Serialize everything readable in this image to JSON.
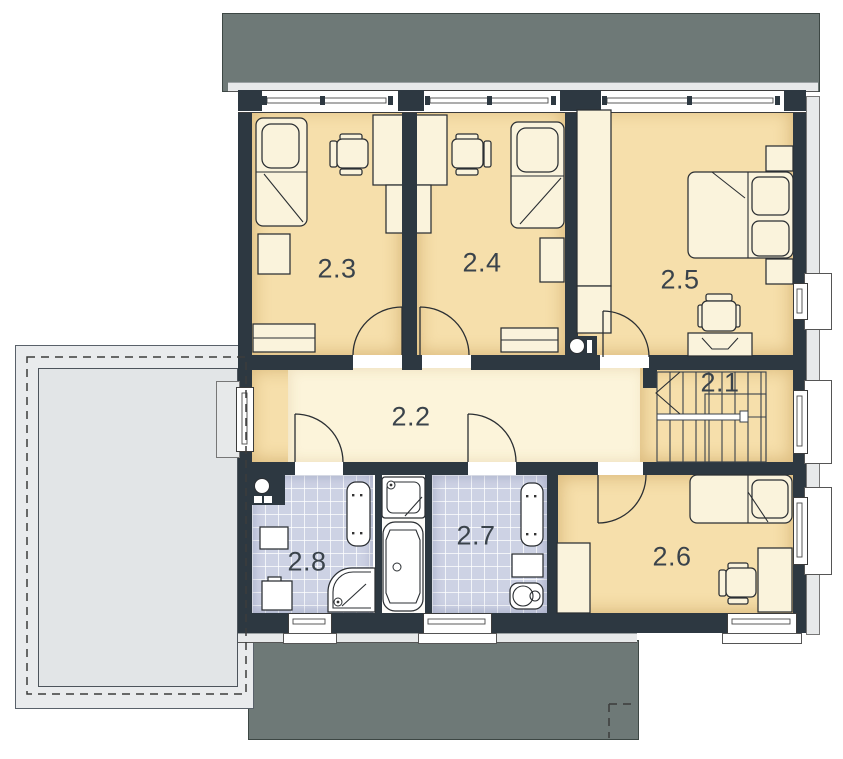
{
  "rooms": [
    {
      "label": "2.1"
    },
    {
      "label": "2.2"
    },
    {
      "label": "2.3"
    },
    {
      "label": "2.4"
    },
    {
      "label": "2.5"
    },
    {
      "label": "2.6"
    },
    {
      "label": "2.7"
    },
    {
      "label": "2.8"
    }
  ],
  "colors": {
    "wall": "#2d3841",
    "room_floor": "#f6dfab",
    "hall_floor": "#fcf4da",
    "furniture": "#faf3dc",
    "bath_tile": "#cdd2e4",
    "roof_dark": "#6e7977",
    "roof_light": "#e9ebed",
    "garage_inner": "#e2e5e7",
    "line": "#2b2f33",
    "label_text": "#3a434b",
    "window_trim": "#e7e9ea"
  }
}
